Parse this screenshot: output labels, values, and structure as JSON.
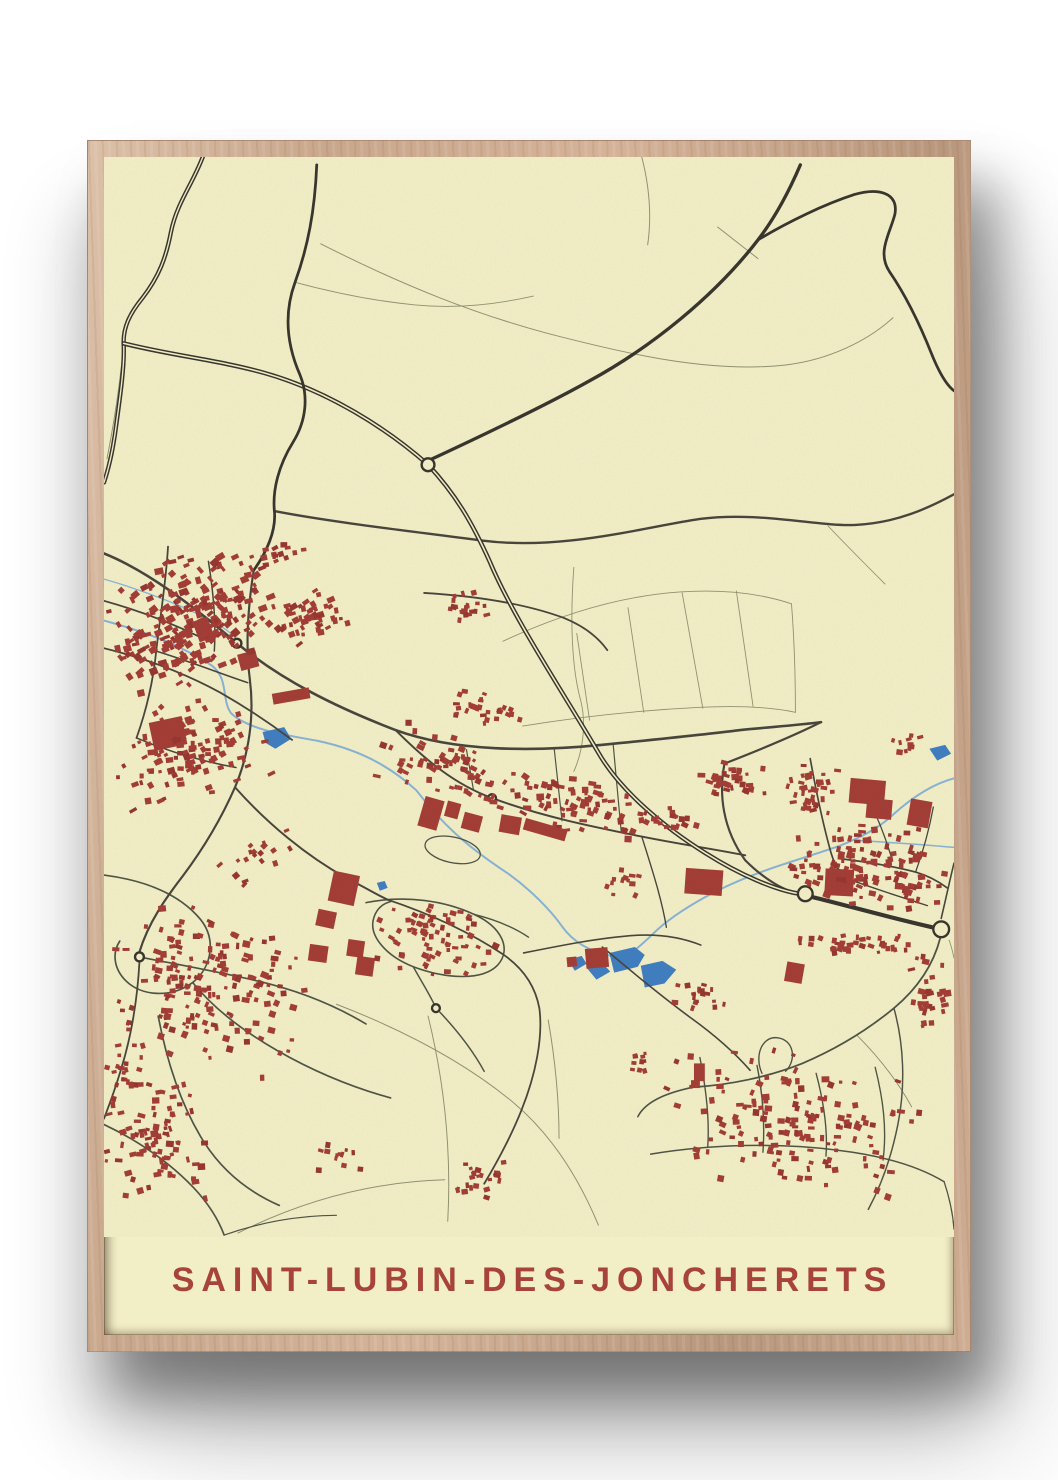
{
  "poster": {
    "title": "SAINT-LUBIN-DES-JONCHERETS",
    "colors": {
      "wall": "#ffffff",
      "frame_wood": "#c8a78c",
      "paper": "#f2eec6",
      "road_major": "#35322b",
      "road_medium": "#45423a",
      "road_residential": "#4c5143",
      "road_minor": "#8f9072",
      "water_line": "#85b2d6",
      "water_fill": "#3d7cc0",
      "building": "#a23a34",
      "building_alt": "#96332e",
      "title": "#a8433c"
    },
    "map": {
      "roads": [
        {
          "l": "maj",
          "w": 4.4,
          "dual": true,
          "d": "M196,148 C186,176 169,196 163,226 C158,252 151,271 134,293 C121,309 114,323 115,341 C116,362 111,396 106,432 C103,452 99,468 95,480"
        },
        {
          "l": "maj",
          "w": 4.6,
          "dual": true,
          "d": "M115,339 C162,351 212,356 258,369 C322,387 382,425 424,462 C452,492 469,521 487,561 C510,616 560,691 597,754 C620,794 666,831 706,856 C741,878 776,893 801,897"
        },
        {
          "l": "maj",
          "w": 4.2,
          "d": "M813,900 C850,909 884,919 936,931"
        },
        {
          "l": "maj",
          "w": 3.4,
          "d": "M424,458 C480,432 541,403 586,378 C651,343 716,290 759,234 C776,212 790,186 802,158"
        },
        {
          "l": "maj",
          "w": 2.8,
          "d": "M759,234 C789,216 826,198 857,188 C881,181 902,186 898,208 C893,228 879,247 893,267 C908,289 923,319 935,349 C943,369 950,381 958,387"
        },
        {
          "l": "maj",
          "w": 2.8,
          "d": "M311,158 C309,205 302,241 289,277 C278,307 280,339 294,371 C303,393 300,418 287,439 C272,463 266,488 268,509 C270,529 260,551 247,569"
        },
        {
          "l": "med",
          "w": 2.4,
          "d": "M268,509 C330,521 420,531 480,539 C560,549 640,526 700,517 C760,509 820,525 858,523 C900,521 932,506 958,492"
        },
        {
          "l": "med",
          "w": 2.6,
          "d": "M95,552 C140,570 186,606 230,643 C276,681 331,708 391,731 C451,753 531,753 601,746 C661,740 701,736 741,731 C771,728 801,726 823,723"
        },
        {
          "l": "med",
          "w": 2.2,
          "d": "M823,723 C801,734 761,751 725,765 C719,796 723,831 746,863 C766,883 786,894 801,897"
        },
        {
          "l": "med",
          "w": 2.0,
          "d": "M391,731 C421,761 451,786 489,800 C541,819 591,829 641,839 C681,847 716,852 746,858"
        },
        {
          "l": "med",
          "w": 2.2,
          "d": "M247,569 C242,601 238,641 243,679 C248,717 242,756 228,789 C214,821 196,851 175,879 C158,901 140,926 131,956"
        },
        {
          "l": "med",
          "w": 1.8,
          "d": "M131,966 C129,1002 123,1041 112,1076 C106,1096 100,1112 95,1125"
        },
        {
          "l": "med",
          "w": 1.8,
          "d": "M95,600 C131,610 166,623 201,641"
        },
        {
          "l": "med",
          "w": 1.8,
          "d": "M95,648 C136,658 176,673 213,693 C241,709 266,726 286,741"
        },
        {
          "l": "med",
          "w": 1.8,
          "d": "M160,545 C158,581 152,616 148,651 C145,681 138,711 128,739"
        },
        {
          "l": "med",
          "w": 1.6,
          "d": "M128,739 C161,753 196,763 229,769"
        },
        {
          "l": "med",
          "w": 1.5,
          "d": "M148,651 C181,661 211,673 241,683"
        },
        {
          "l": "med",
          "w": 1.5,
          "d": "M201,560 C206,591 209,621 207,651"
        },
        {
          "l": "med",
          "w": 2.0,
          "d": "M228,789 C261,826 301,859 341,881 C361,891 372,898 383,903"
        },
        {
          "l": "med",
          "w": 1.8,
          "d": "M383,903 C431,919 471,939 501,959 C521,973 533,991 537,1013 C541,1043 533,1081 519,1116 C509,1141 496,1166 481,1191"
        },
        {
          "l": "med",
          "w": 1.8,
          "d": "M420,592 C470,595 520,602 561,617 C581,625 596,636 606,650"
        },
        {
          "l": "med",
          "w": 1.7,
          "d": "M812,760 C818,793 824,823 833,855 C838,873 847,881 859,885"
        },
        {
          "l": "med",
          "w": 1.7,
          "d": "M847,862 C871,865 896,869 919,875 C933,879 943,885 951,891"
        },
        {
          "l": "med",
          "w": 1.4,
          "d": "M859,885 C881,893 906,901 931,909"
        },
        {
          "l": "med",
          "w": 1.3,
          "d": "M871,800 C881,821 889,841 895,862"
        },
        {
          "l": "med",
          "w": 1.3,
          "d": "M919,875 C927,853 933,831 937,809"
        },
        {
          "l": "med",
          "w": 1.6,
          "d": "M945,922 C950,901 954,882 958,866"
        },
        {
          "l": "med",
          "w": 1.6,
          "d": "M521,957 C561,949 601,941 637,939 C661,938 681,941 701,949"
        },
        {
          "l": "med",
          "w": 1.6,
          "d": "M601,951 C631,976 661,1001 691,1023 C716,1041 736,1059 751,1076"
        },
        {
          "l": "med",
          "w": 1.4,
          "d": "M641,839 C651,871 661,901 666,931"
        },
        {
          "l": "res",
          "w": 1.7,
          "d": "M95,878 C141,884 173,899 193,923 C209,943 205,971 185,987 C163,1003 133,1001 117,985 C105,973 103,957 111,945"
        },
        {
          "l": "res",
          "w": 1.7,
          "d": "M131,961 C166,968 206,975 249,985 C293,995 331,1011 361,1029"
        },
        {
          "l": "res",
          "w": 1.7,
          "d": "M185,987 C206,1013 236,1036 271,1056 C306,1076 346,1093 386,1104"
        },
        {
          "l": "res",
          "w": 1.7,
          "d": "M150,1021 C158,1063 171,1106 193,1143 C213,1177 241,1199 273,1213"
        },
        {
          "l": "res",
          "w": 1.7,
          "d": "M95,1131 C129,1147 161,1169 186,1195 C201,1211 211,1227 217,1243"
        },
        {
          "l": "res",
          "w": 1.2,
          "d": "M217,1243 C251,1231 291,1223 331,1223"
        },
        {
          "l": "res",
          "w": 1.6,
          "d": "M361,906 C401,898 441,904 471,918 C499,931 509,953 495,969 C479,986 441,983 409,971 C381,960 363,939 369,921 C372,912 378,907 386,905"
        },
        {
          "l": "res",
          "w": 1.5,
          "d": "M409,971 C419,989 428,1003 432,1013"
        },
        {
          "l": "res",
          "w": 1.5,
          "d": "M436,1017 C452,1034 469,1055 481,1077"
        },
        {
          "l": "res",
          "w": 1.4,
          "d": "M471,918 C491,923 511,931 526,941"
        },
        {
          "l": "res",
          "w": 1.3,
          "d": "M427,857 a22,10 12 1 0 44,-9 a22,10 12 1 0 -44,9"
        },
        {
          "l": "res",
          "w": 1.8,
          "d": "M944,942 C937,969 921,993 897,1013 C869,1036 837,1055 804,1069 C769,1083 729,1091 694,1093"
        },
        {
          "l": "res",
          "w": 1.6,
          "d": "M694,1093 C664,1099 644,1109 637,1123"
        },
        {
          "l": "res",
          "w": 1.4,
          "d": "M700,1063 C706,1093 710,1123 708,1153"
        },
        {
          "l": "res",
          "w": 1.4,
          "d": "M758,1071 C764,1101 766,1131 764,1159"
        },
        {
          "l": "res",
          "w": 1.4,
          "d": "M818,1079 C826,1109 830,1137 828,1163"
        },
        {
          "l": "res",
          "w": 1.4,
          "d": "M878,1073 C886,1105 890,1135 886,1167"
        },
        {
          "l": "res",
          "w": 1.5,
          "d": "M650,1161 C710,1151 780,1149 840,1157 C890,1163 925,1175 948,1189"
        },
        {
          "l": "res",
          "w": 1.4,
          "d": "M763,1079 C755,1061 763,1041 779,1043 C795,1045 799,1065 787,1077"
        },
        {
          "l": "res",
          "w": 1.5,
          "d": "M897,1013 C907,1049 909,1091 901,1131 C895,1161 885,1191 871,1217"
        },
        {
          "l": "res",
          "w": 1.3,
          "d": "M948,1189 C954,1207 957,1223 958,1237"
        },
        {
          "l": "res",
          "w": 1.2,
          "d": "M463,751 L470,791"
        },
        {
          "l": "res",
          "w": 1.2,
          "d": "M552,749 L560,823"
        },
        {
          "l": "res",
          "w": 1.2,
          "d": "M612,746 L620,833"
        },
        {
          "l": "min",
          "w": 1.0,
          "d": "M315,238 C400,281 471,309 546,329 C631,351 711,369 786,361 C831,356 871,336 896,313"
        },
        {
          "l": "min",
          "w": 1.0,
          "d": "M641,150 C649,181 651,211 647,239"
        },
        {
          "l": "min",
          "w": 1.0,
          "d": "M718,221 L759,253"
        },
        {
          "l": "min",
          "w": 0.9,
          "d": "M289,277 C330,288 370,296 411,300 C451,304 491,300 531,291"
        },
        {
          "l": "min",
          "w": 0.9,
          "d": "M500,641 C560,613 620,595 680,591 C725,588 763,593 793,603"
        },
        {
          "l": "min",
          "w": 0.9,
          "d": "M520,727 C580,717 640,711 700,708 C740,706 773,708 797,713"
        },
        {
          "l": "min",
          "w": 0.9,
          "d": "M575,633 L588,721"
        },
        {
          "l": "min",
          "w": 0.9,
          "d": "M627,607 L643,713"
        },
        {
          "l": "min",
          "w": 0.9,
          "d": "M682,592 L703,709"
        },
        {
          "l": "min",
          "w": 0.9,
          "d": "M737,590 L754,707"
        },
        {
          "l": "min",
          "w": 0.9,
          "d": "M793,603 C796,641 797,677 797,713"
        },
        {
          "l": "min",
          "w": 0.9,
          "d": "M572,566 C568,621 570,669 579,701 C585,725 581,753 572,773"
        },
        {
          "l": "min",
          "w": 0.9,
          "d": "M830,524 C850,545 870,565 888,583"
        },
        {
          "l": "min",
          "w": 1.0,
          "d": "M331,1009 C401,1036 463,1069 511,1109 C549,1141 577,1185 597,1233"
        },
        {
          "l": "min",
          "w": 1.0,
          "d": "M424,1021 C440,1086 448,1156 444,1229"
        },
        {
          "l": "min",
          "w": 1.0,
          "d": "M546,1025 C553,1065 557,1105 557,1145"
        },
        {
          "l": "min",
          "w": 1.0,
          "d": "M231,1241 C301,1206 371,1189 441,1187"
        },
        {
          "l": "min",
          "w": 1.0,
          "d": "M860,1041 C880,1061 900,1086 915,1113"
        },
        {
          "l": "min",
          "w": 1.0,
          "d": "M115,341 C111,381 105,421 98,456"
        },
        {
          "l": "min",
          "w": 0.9,
          "d": "M953,944 C956,952 957,958 958,962"
        }
      ],
      "rivers": [
        {
          "w": 2.0,
          "d": "M95,620 C140,632 178,648 205,666 C222,680 214,700 224,714 C242,731 280,736 312,742 C360,752 390,772 412,792 C438,826 462,848 506,877 C528,893 548,913 560,930 C572,947 590,956 610,960"
        },
        {
          "w": 1.3,
          "d": "M95,578 C130,588 162,600 192,614 C208,621 222,630 233,642"
        },
        {
          "w": 2.0,
          "d": "M958,780 C935,786 915,800 897,816 C880,832 862,840 843,848 C820,856 800,862 782,868 C755,877 728,888 706,900 C686,911 666,924 652,938 C643,947 636,952 630,958"
        },
        {
          "w": 1.5,
          "d": "M860,843 C893,845 925,847 958,850"
        }
      ],
      "ponds": [
        "M608,957 l26,-6 l10,8 l-7,12 l-24,6 z",
        "M640,970 l22,-5 l14,9 l-12,14 l-20,4 z",
        "M585,972 l16,-5 l8,9 l-14,8 z",
        "M566,964 l14,-4 l5,8 l-12,7 z",
        "M256,733 l22,-5 l7,12 l-16,10 l-10,-6 z",
        "M372,886 l8,-2 l3,7 l-8,3 z",
        "M933,750 l16,-4 l6,9 l-14,7 z"
      ],
      "roundabouts": [
        [
          424,
          462,
          6.5
        ],
        [
          807,
          897,
          7.5
        ],
        [
          945,
          933,
          8
        ],
        [
          230,
          643,
          4.5
        ],
        [
          131,
          961,
          4.5
        ],
        [
          432,
          1013,
          4
        ],
        [
          489,
          800,
          4
        ]
      ],
      "buildings_large": [
        [
          143,
          720,
          34,
          29,
          -12
        ],
        [
          188,
          618,
          16,
          22,
          -20
        ],
        [
          232,
          652,
          19,
          17,
          -15
        ],
        [
          266,
          691,
          38,
          11,
          -10
        ],
        [
          417,
          800,
          20,
          31,
          16
        ],
        [
          442,
          804,
          14,
          16,
          15
        ],
        [
          459,
          816,
          19,
          17,
          15
        ],
        [
          497,
          818,
          21,
          18,
          10
        ],
        [
          521,
          826,
          44,
          12,
          16
        ],
        [
          685,
          872,
          38,
          26,
          4
        ],
        [
          852,
          781,
          36,
          25,
          5
        ],
        [
          869,
          801,
          26,
          20,
          5
        ],
        [
          912,
          802,
          22,
          27,
          10
        ],
        [
          827,
          872,
          29,
          27,
          3
        ],
        [
          325,
          876,
          27,
          31,
          12
        ],
        [
          311,
          914,
          19,
          17,
          12
        ],
        [
          303,
          949,
          19,
          17,
          8
        ],
        [
          342,
          944,
          17,
          17,
          8
        ],
        [
          351,
          961,
          18,
          19,
          8
        ],
        [
          584,
          952,
          23,
          20,
          -5
        ],
        [
          565,
          961,
          10,
          10,
          -5
        ],
        [
          694,
          1069,
          11,
          18,
          0
        ],
        [
          691,
          1086,
          9,
          8,
          0
        ],
        [
          787,
          967,
          18,
          20,
          10
        ]
      ],
      "building_clusters": [
        [
          185,
          620,
          95,
          66,
          -28,
          240,
          3,
          9,
          11
        ],
        [
          183,
          754,
          82,
          52,
          -15,
          115,
          3,
          8,
          22
        ],
        [
          300,
          618,
          42,
          30,
          -22,
          48,
          3,
          8,
          33
        ],
        [
          268,
          554,
          32,
          12,
          -12,
          16,
          3,
          7,
          44
        ],
        [
          455,
          773,
          88,
          36,
          18,
          70,
          3,
          8,
          55
        ],
        [
          580,
          810,
          78,
          28,
          10,
          70,
          3,
          8,
          66
        ],
        [
          487,
          712,
          44,
          20,
          10,
          28,
          3,
          7,
          77
        ],
        [
          460,
          607,
          27,
          19,
          0,
          22,
          3,
          7,
          88
        ],
        [
          730,
          784,
          44,
          22,
          6,
          34,
          3,
          8,
          99
        ],
        [
          870,
          868,
          84,
          46,
          8,
          130,
          3,
          8,
          110
        ],
        [
          812,
          790,
          30,
          34,
          0,
          34,
          3,
          8,
          121
        ],
        [
          862,
          948,
          72,
          12,
          3,
          40,
          3,
          7,
          132
        ],
        [
          935,
          1000,
          24,
          42,
          0,
          28,
          3,
          8,
          143
        ],
        [
          200,
          993,
          108,
          82,
          10,
          170,
          3,
          8,
          154
        ],
        [
          150,
          1148,
          64,
          72,
          0,
          85,
          3,
          8,
          165
        ],
        [
          430,
          943,
          68,
          40,
          12,
          75,
          3,
          7,
          176
        ],
        [
          795,
          1128,
          138,
          72,
          8,
          150,
          3,
          8,
          187
        ],
        [
          480,
          1184,
          38,
          23,
          0,
          22,
          3,
          7,
          198
        ],
        [
          670,
          818,
          30,
          18,
          10,
          20,
          3,
          7,
          209
        ],
        [
          252,
          858,
          55,
          26,
          -30,
          18,
          3,
          7,
          220
        ],
        [
          118,
          1078,
          28,
          38,
          0,
          20,
          3,
          7,
          231
        ],
        [
          330,
          1163,
          30,
          18,
          0,
          12,
          3,
          7,
          242
        ],
        [
          700,
          1000,
          33,
          24,
          0,
          18,
          3,
          7,
          253
        ],
        [
          640,
          1068,
          20,
          14,
          0,
          10,
          3,
          6,
          264
        ],
        [
          908,
          745,
          22,
          12,
          0,
          10,
          3,
          7,
          275
        ],
        [
          620,
          885,
          25,
          15,
          8,
          12,
          3,
          7,
          286
        ]
      ]
    }
  }
}
